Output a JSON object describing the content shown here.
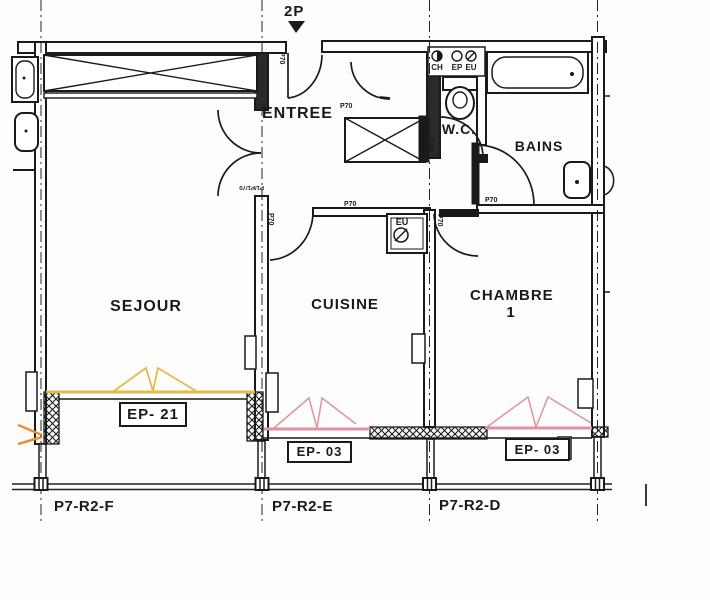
{
  "title_marker": {
    "label": "2P"
  },
  "rooms": {
    "sejour": "SEJOUR",
    "entree": "ENTREE",
    "cuisine": "CUISINE",
    "wc": "W.C.",
    "bains": "BAINS",
    "chambre": "CHAMBRE",
    "chambre_number": "1"
  },
  "window_tags": {
    "sejour": "EP- 21",
    "cuisine": "EP- 03",
    "chambre": "EP- 03"
  },
  "axis_labels": {
    "f": "P7-R2-F",
    "e": "P7-R2-E",
    "d": "P7-R2-D"
  },
  "door_tags": {
    "p70": "P70",
    "p80": "P80",
    "double_door": "P1/P1/70"
  },
  "utility_tags": {
    "ch": "CH",
    "ep": "EP",
    "eu": "EU"
  },
  "colors": {
    "wall": "#1a1a1a",
    "sejour_window": "#E5B94E",
    "pink_window": "#DE93A5",
    "arrow_orange": "#E8903A"
  }
}
